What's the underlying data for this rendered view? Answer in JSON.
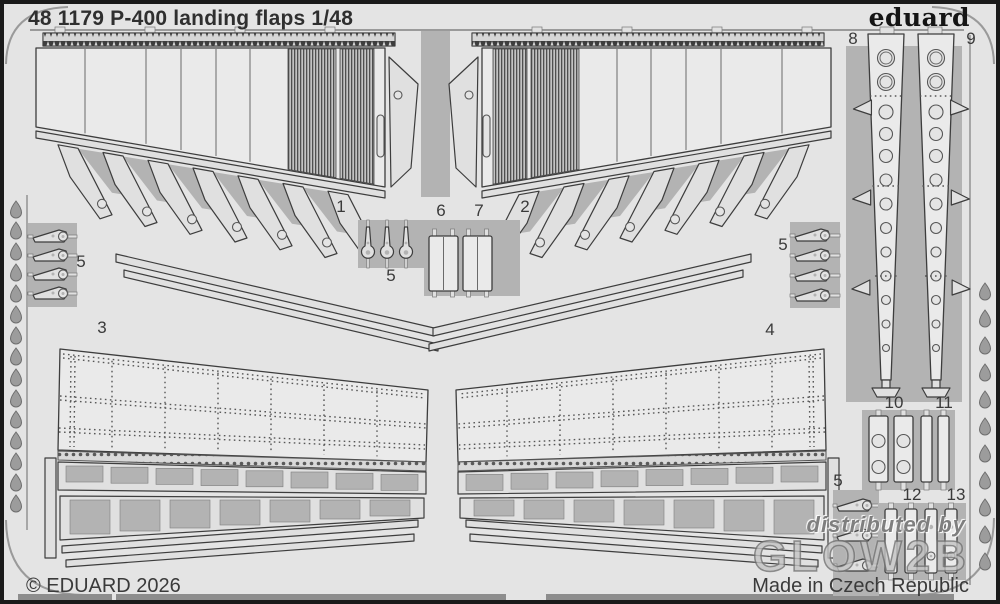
{
  "header": {
    "catalog_title": "48 1179 P-400 landing flaps 1/48",
    "brand_logo": "eduard"
  },
  "footer": {
    "copyright": "© EDUARD 2026",
    "made_in": "Made in Czech Republic"
  },
  "watermark": {
    "line1": "distributed by",
    "line2": "GLOW2B"
  },
  "part_labels": [
    {
      "id": "1",
      "x": 341,
      "y": 207
    },
    {
      "id": "2",
      "x": 525,
      "y": 207
    },
    {
      "id": "3",
      "x": 102,
      "y": 328
    },
    {
      "id": "4",
      "x": 770,
      "y": 330
    },
    {
      "id": "5",
      "x": 81,
      "y": 262
    },
    {
      "id": "5",
      "x": 783,
      "y": 245
    },
    {
      "id": "5",
      "x": 391,
      "y": 276
    },
    {
      "id": "5",
      "x": 838,
      "y": 481
    },
    {
      "id": "6",
      "x": 441,
      "y": 211
    },
    {
      "id": "7",
      "x": 479,
      "y": 211
    },
    {
      "id": "8",
      "x": 853,
      "y": 39
    },
    {
      "id": "9",
      "x": 971,
      "y": 39
    },
    {
      "id": "10",
      "x": 894,
      "y": 403
    },
    {
      "id": "11",
      "x": 944,
      "y": 403
    },
    {
      "id": "12",
      "x": 912,
      "y": 495
    },
    {
      "id": "13",
      "x": 956,
      "y": 495
    }
  ],
  "colors": {
    "frame": "#1a1a1a",
    "sheet": "#e4e4e4",
    "web": "#b3b3b3",
    "part": "#e0e0e0",
    "part_bright": "#eaeaea",
    "outline": "#3d3d3d",
    "hatch_dark": "#4f4f4f",
    "text": "#2f2f2f",
    "label": "#3a3a3a",
    "watermark": "#8a8a8a"
  }
}
